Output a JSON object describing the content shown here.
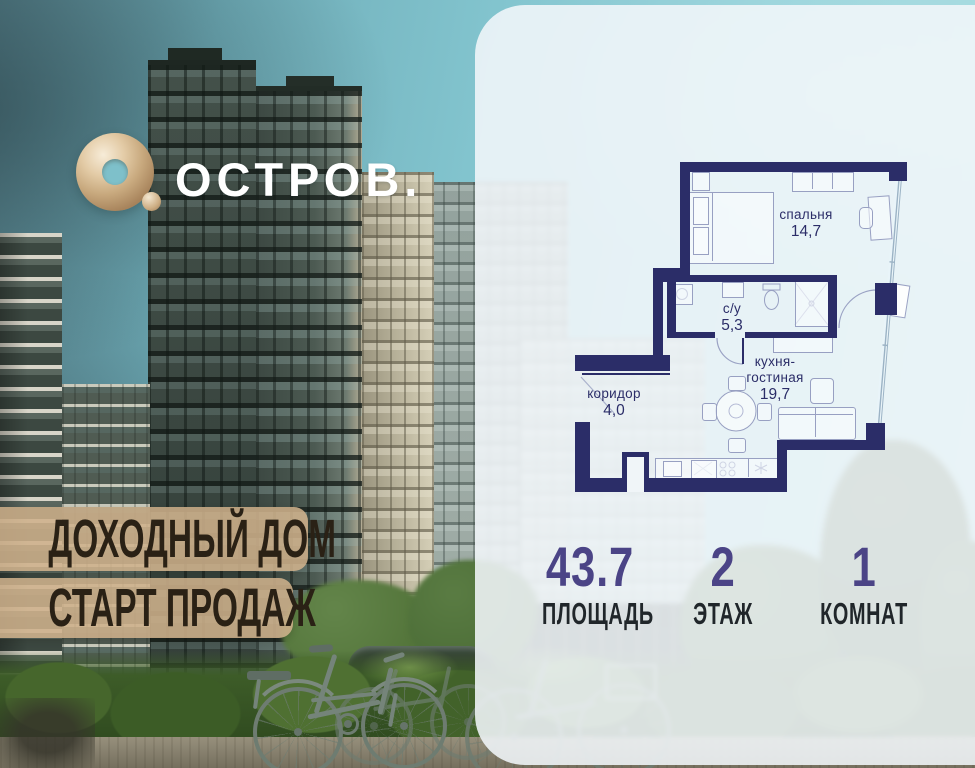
{
  "brand": {
    "name": "ОСТРОВ.",
    "mark": "О."
  },
  "banners": {
    "line1": "ДОХОДНЫЙ ДОМ",
    "line2": "СТАРТ ПРОДАЖ"
  },
  "floorplan": {
    "rooms": [
      {
        "id": "bedroom",
        "name": "спальня",
        "area": "14,7"
      },
      {
        "id": "bathroom",
        "name": "с/у",
        "area": "5,3"
      },
      {
        "id": "corridor",
        "name": "коридор",
        "area": "4,0"
      },
      {
        "id": "kitchen-living",
        "name_line1": "кухня-",
        "name_line2": "гостиная",
        "area": "19,7"
      }
    ]
  },
  "stats": [
    {
      "value": "43.7",
      "label": "ПЛОЩАДЬ"
    },
    {
      "value": "2",
      "label": "ЭТАЖ"
    },
    {
      "value": "1",
      "label": "КОМНАТ"
    }
  ],
  "colors": {
    "plan_wall": "#2b2d68",
    "accent_gold": "#d9bd97",
    "banner_tan": "#cead85",
    "stat_number": "#4b4486",
    "sky_teal": "#7fc2cc"
  }
}
